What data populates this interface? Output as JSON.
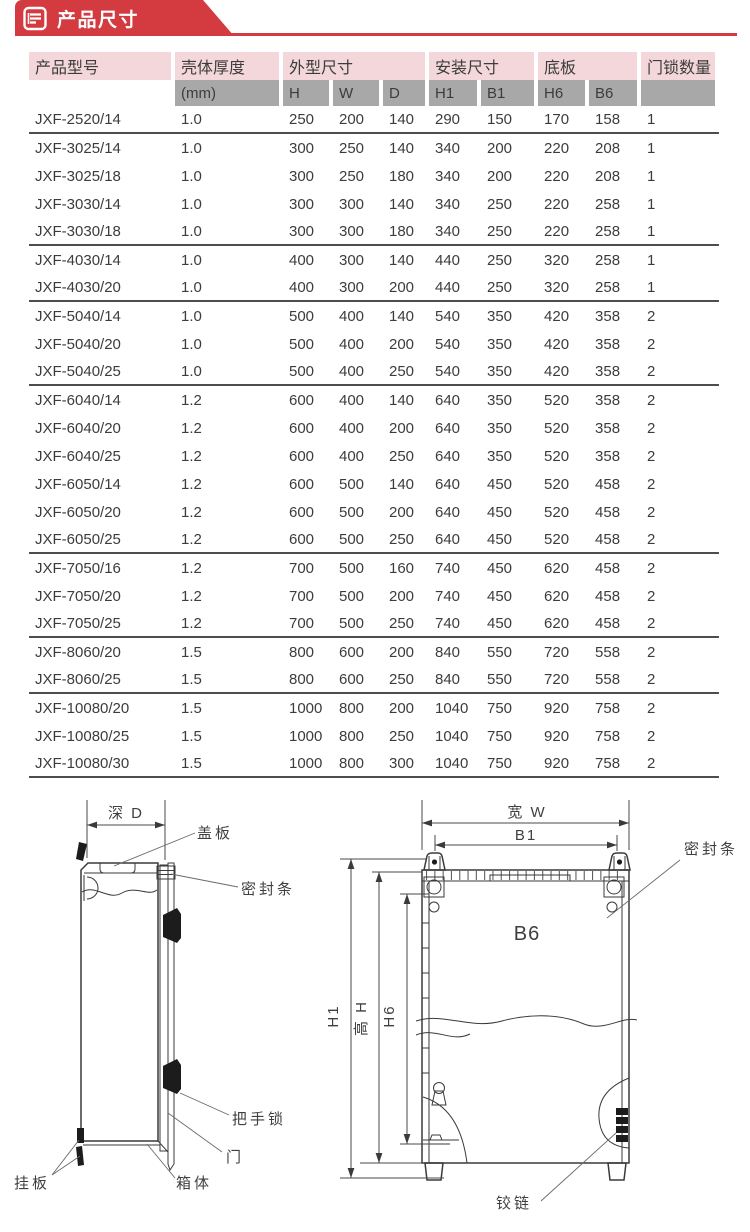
{
  "banner": {
    "title": "产品尺寸",
    "accent_color": "#d43b41",
    "icon": "document-icon"
  },
  "table": {
    "groups": [
      {
        "label": "产品型号"
      },
      {
        "label": "壳体厚度"
      },
      {
        "label": "外型尺寸"
      },
      {
        "label": "安装尺寸"
      },
      {
        "label": "底板"
      },
      {
        "label": "门锁数量"
      }
    ],
    "subheaders": [
      "",
      "(mm)",
      "H",
      "W",
      "D",
      "H1",
      "B1",
      "H6",
      "B6",
      ""
    ],
    "rows": [
      {
        "cells": [
          "JXF-2520/14",
          "1.0",
          "250",
          "200",
          "140",
          "290",
          "150",
          "170",
          "158",
          "1"
        ],
        "group_end": true
      },
      {
        "cells": [
          "JXF-3025/14",
          "1.0",
          "300",
          "250",
          "140",
          "340",
          "200",
          "220",
          "208",
          "1"
        ],
        "group_end": false
      },
      {
        "cells": [
          "JXF-3025/18",
          "1.0",
          "300",
          "250",
          "180",
          "340",
          "200",
          "220",
          "208",
          "1"
        ],
        "group_end": false
      },
      {
        "cells": [
          "JXF-3030/14",
          "1.0",
          "300",
          "300",
          "140",
          "340",
          "250",
          "220",
          "258",
          "1"
        ],
        "group_end": false
      },
      {
        "cells": [
          "JXF-3030/18",
          "1.0",
          "300",
          "300",
          "180",
          "340",
          "250",
          "220",
          "258",
          "1"
        ],
        "group_end": true
      },
      {
        "cells": [
          "JXF-4030/14",
          "1.0",
          "400",
          "300",
          "140",
          "440",
          "250",
          "320",
          "258",
          "1"
        ],
        "group_end": false
      },
      {
        "cells": [
          "JXF-4030/20",
          "1.0",
          "400",
          "300",
          "200",
          "440",
          "250",
          "320",
          "258",
          "1"
        ],
        "group_end": true
      },
      {
        "cells": [
          "JXF-5040/14",
          "1.0",
          "500",
          "400",
          "140",
          "540",
          "350",
          "420",
          "358",
          "2"
        ],
        "group_end": false
      },
      {
        "cells": [
          "JXF-5040/20",
          "1.0",
          "500",
          "400",
          "200",
          "540",
          "350",
          "420",
          "358",
          "2"
        ],
        "group_end": false
      },
      {
        "cells": [
          "JXF-5040/25",
          "1.0",
          "500",
          "400",
          "250",
          "540",
          "350",
          "420",
          "358",
          "2"
        ],
        "group_end": true
      },
      {
        "cells": [
          "JXF-6040/14",
          "1.2",
          "600",
          "400",
          "140",
          "640",
          "350",
          "520",
          "358",
          "2"
        ],
        "group_end": false
      },
      {
        "cells": [
          "JXF-6040/20",
          "1.2",
          "600",
          "400",
          "200",
          "640",
          "350",
          "520",
          "358",
          "2"
        ],
        "group_end": false
      },
      {
        "cells": [
          "JXF-6040/25",
          "1.2",
          "600",
          "400",
          "250",
          "640",
          "350",
          "520",
          "358",
          "2"
        ],
        "group_end": false
      },
      {
        "cells": [
          "JXF-6050/14",
          "1.2",
          "600",
          "500",
          "140",
          "640",
          "450",
          "520",
          "458",
          "2"
        ],
        "group_end": false
      },
      {
        "cells": [
          "JXF-6050/20",
          "1.2",
          "600",
          "500",
          "200",
          "640",
          "450",
          "520",
          "458",
          "2"
        ],
        "group_end": false
      },
      {
        "cells": [
          "JXF-6050/25",
          "1.2",
          "600",
          "500",
          "250",
          "640",
          "450",
          "520",
          "458",
          "2"
        ],
        "group_end": true
      },
      {
        "cells": [
          "JXF-7050/16",
          "1.2",
          "700",
          "500",
          "160",
          "740",
          "450",
          "620",
          "458",
          "2"
        ],
        "group_end": false
      },
      {
        "cells": [
          "JXF-7050/20",
          "1.2",
          "700",
          "500",
          "200",
          "740",
          "450",
          "620",
          "458",
          "2"
        ],
        "group_end": false
      },
      {
        "cells": [
          "JXF-7050/25",
          "1.2",
          "700",
          "500",
          "250",
          "740",
          "450",
          "620",
          "458",
          "2"
        ],
        "group_end": true
      },
      {
        "cells": [
          "JXF-8060/20",
          "1.5",
          "800",
          "600",
          "200",
          "840",
          "550",
          "720",
          "558",
          "2"
        ],
        "group_end": false
      },
      {
        "cells": [
          "JXF-8060/25",
          "1.5",
          "800",
          "600",
          "250",
          "840",
          "550",
          "720",
          "558",
          "2"
        ],
        "group_end": true
      },
      {
        "cells": [
          "JXF-10080/20",
          "1.5",
          "1000",
          "800",
          "200",
          "1040",
          "750",
          "920",
          "758",
          "2"
        ],
        "group_end": false
      },
      {
        "cells": [
          "JXF-10080/25",
          "1.5",
          "1000",
          "800",
          "250",
          "1040",
          "750",
          "920",
          "758",
          "2"
        ],
        "group_end": false
      },
      {
        "cells": [
          "JXF-10080/30",
          "1.5",
          "1000",
          "800",
          "300",
          "1040",
          "750",
          "920",
          "758",
          "2"
        ],
        "group_end": true
      }
    ]
  },
  "diagrams": {
    "side_view": {
      "dim_depth": "深 D",
      "labels": {
        "cover": "盖板",
        "seal": "密封条",
        "handle_lock": "把手锁",
        "door": "门",
        "hang_plate": "挂板",
        "box_body": "箱体"
      }
    },
    "front_view": {
      "dim_width": "宽 W",
      "dim_b1": "B1",
      "dim_b6": "B6",
      "dim_h1": "H1",
      "dim_h": "高 H",
      "dim_h6": "H6",
      "labels": {
        "seal": "密封条",
        "hinge": "铰链"
      }
    }
  }
}
